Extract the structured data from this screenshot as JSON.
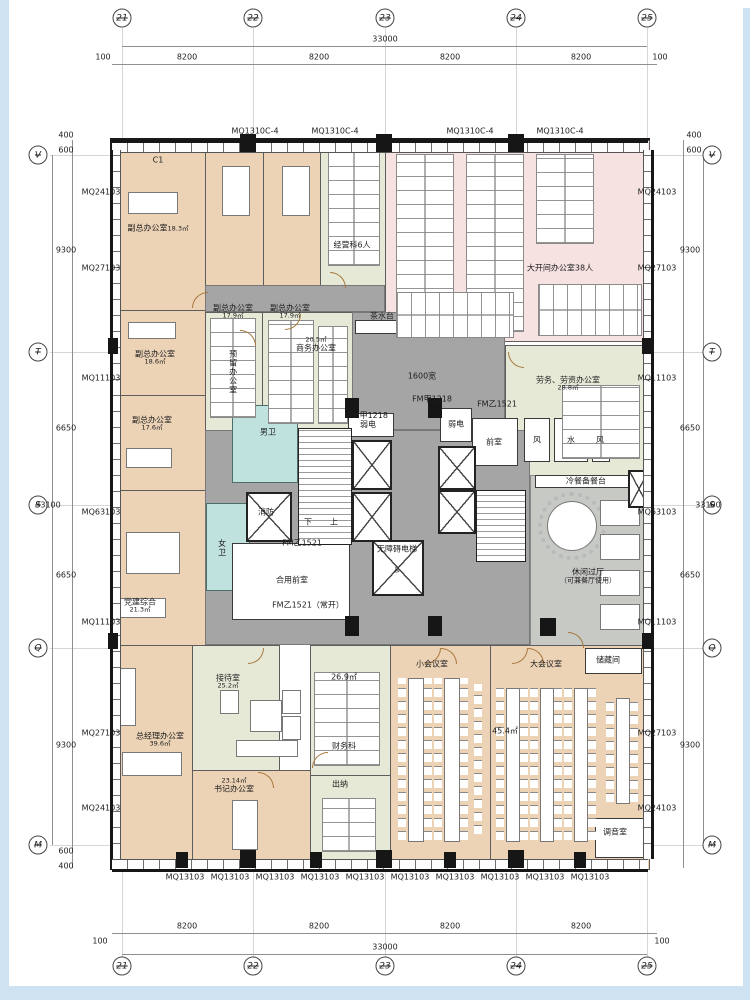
{
  "grid": {
    "cols": [
      "21",
      "22",
      "23",
      "24",
      "25"
    ],
    "rows": [
      "V",
      "T",
      "S",
      "Q",
      "M"
    ]
  },
  "dims": {
    "h_total": "33000",
    "h_seg": "8200",
    "h_edge": "100",
    "v_total": "33100",
    "v_seg_a": "9300",
    "v_seg_b": "6650",
    "v_edge_a": "600",
    "v_edge_b": "400"
  },
  "walls": {
    "side": [
      "MQ24103",
      "MQ27103",
      "MQ11103",
      "MQ63103",
      "MQ11103",
      "MQ27103",
      "MQ24103"
    ],
    "top_label": "MQ1310C-4",
    "bottom_label": "MQ13103"
  },
  "rooms": {
    "deputy1": {
      "name": "副总办公室",
      "area": "18.3㎡"
    },
    "deputy2": {
      "name": "副总办公室",
      "area": "17.9㎡"
    },
    "deputy3": {
      "name": "副总办公室",
      "area": "17.9㎡"
    },
    "deputy4": {
      "name": "副总办公室",
      "area": "18.6㎡"
    },
    "deputy5": {
      "name": "副总办公室",
      "area": "17.6㎡"
    },
    "operations": {
      "name": "经营科6人"
    },
    "open_office": {
      "name": "大开间办公室38人"
    },
    "reserved": {
      "name": "预留办公室"
    },
    "business": {
      "name": "商务办公室",
      "area": "20.5㎡"
    },
    "labor": {
      "name": "劳务、劳资办公室",
      "area": "28.8㎡"
    },
    "party": {
      "name": "党建综合",
      "area": "21.3㎡"
    },
    "gm": {
      "name": "总经理办公室",
      "area": "39.6㎡"
    },
    "reception": {
      "name": "接待室",
      "area": "25.2㎡"
    },
    "secretary": {
      "name": "书记办公室",
      "area": "23.14㎡"
    },
    "finance": {
      "name": "财务科",
      "area": "26.9㎡"
    },
    "cashier": {
      "name": "出纳"
    },
    "small_meeting": {
      "name": "小会议室"
    },
    "large_meeting": {
      "name": "大会议室",
      "area": "45.4㎡"
    },
    "leisure": {
      "name": "休闲过厅",
      "sub": "（可兼餐厅使用）"
    },
    "storage": {
      "name": "储藏间"
    },
    "tuning": {
      "name": "调音室"
    }
  },
  "core": {
    "male_wc": "男卫",
    "female_wc": "女卫",
    "shared_ante": "合用前室",
    "ante": "前室",
    "weak": "弱电",
    "water": "水",
    "wind": "风",
    "fire": "消防",
    "accessible": "无障碍电梯",
    "up": "上",
    "down": "下",
    "wheelchair": "♿"
  },
  "ann": {
    "tea": "茶水台",
    "buffet": "冷餐备餐台",
    "fm_jia": "FM甲1218",
    "fm_yi": "FM乙1521",
    "fm_yi_open": "FM乙1521（常开）",
    "width_note": "1600宽",
    "c1": "C1"
  },
  "colors": {
    "room_peach": "#ecd3b6",
    "room_pink": "#f5e2e1",
    "room_green": "#e6e9d6",
    "corridor_gray": "#a5a5a5",
    "leisure_gray": "#c7c9c5",
    "toilet_teal": "#bfe2df",
    "wall_dark": "#1a1a1a",
    "frame_blue": "#cfe2f2"
  }
}
